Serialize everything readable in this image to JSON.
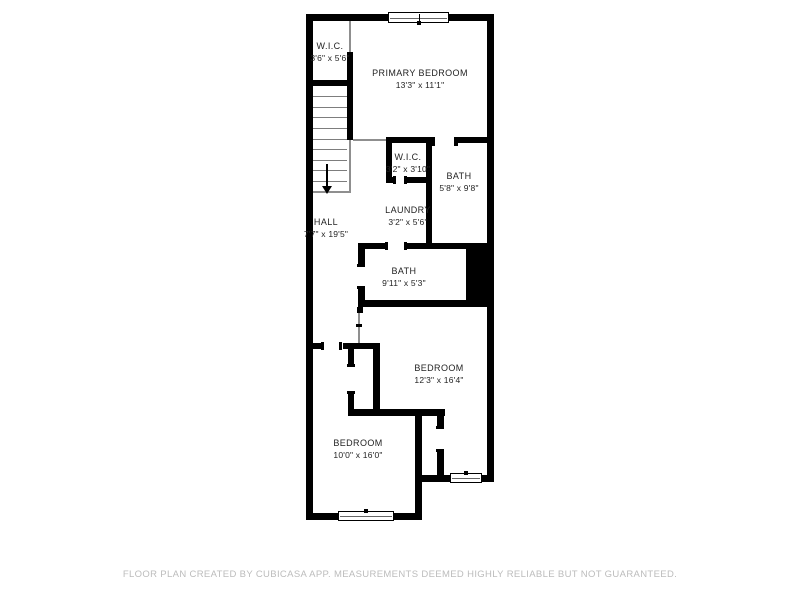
{
  "floorplan": {
    "rooms": [
      {
        "name": "W.I.C.",
        "dims": "3'6\" x 5'6\""
      },
      {
        "name": "PRIMARY BEDROOM",
        "dims": "13'3\" x 11'1\""
      },
      {
        "name": "W.I.C.",
        "dims": "3'2\" x 3'10\""
      },
      {
        "name": "BATH",
        "dims": "5'8\" x 9'8\""
      },
      {
        "name": "LAUNDRY",
        "dims": "3'2\" x 5'6\""
      },
      {
        "name": "HALL",
        "dims": "7'7\" x 19'5\""
      },
      {
        "name": "BATH",
        "dims": "9'11\" x 5'3\""
      },
      {
        "name": "BEDROOM",
        "dims": "12'3\" x 16'4\""
      },
      {
        "name": "BEDROOM",
        "dims": "10'0\" x 16'0\""
      }
    ],
    "features": [
      "staircase-down",
      "window-top",
      "window-bottom-left",
      "window-bottom-right",
      "shaft"
    ],
    "footer": "FLOOR PLAN CREATED BY CUBICASA APP. MEASUREMENTS DEEMED HIGHLY RELIABLE BUT NOT GUARANTEED.",
    "colors": {
      "wall": "#000000",
      "background": "#ffffff",
      "open_line": "#8f8f8f",
      "label_text": "#232323",
      "footer_text": "#bcbcbc"
    }
  }
}
